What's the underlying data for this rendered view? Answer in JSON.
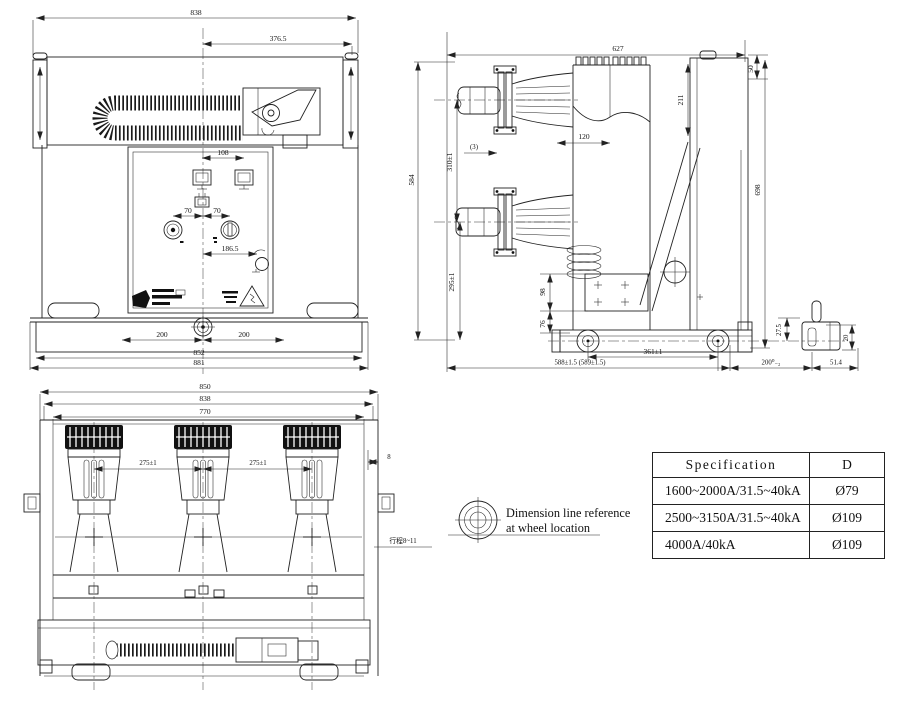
{
  "views": {
    "front": {
      "dims": {
        "total_width": "838",
        "offset_right": "376.5",
        "window_pitch": "108",
        "knob_left": "70",
        "knob_right": "70",
        "panel_dim": "186.5",
        "base_left": "200",
        "base_right": "200",
        "base_width": "852",
        "base_total": "881"
      }
    },
    "side": {
      "dims": {
        "top_depth": "627",
        "top_step": "50",
        "height": "584",
        "pole_pitch": "310±1",
        "note3": "(3)",
        "depth_120": "120",
        "frame_211": "211",
        "rear_height": "698",
        "arm_height": "295±1",
        "plate_98": "98",
        "plate_76": "76",
        "wheel_pitch": "361±1",
        "overall_depth": "588±1.5 (589±1.5)",
        "axle_27_5": "27.5",
        "ext_200": "200⁰₋₂",
        "ext_51_4": "51.4",
        "wheel_20": "20"
      }
    },
    "plan": {
      "dims": {
        "total_width": "850",
        "frame_width": "838",
        "inner_width": "770",
        "pole_pitch_1": "275±1",
        "pole_pitch_2": "275±1",
        "edge_8": "8",
        "travel": "行程8~11"
      }
    }
  },
  "note": {
    "line1": "Dimension line reference",
    "line2": "at wheel location"
  },
  "spec_table": {
    "header_spec": "Specification",
    "header_d": "D",
    "rows": [
      {
        "spec": "1600~2000A/31.5~40kA",
        "d": "Ø79"
      },
      {
        "spec": "2500~3150A/31.5~40kA",
        "d": "Ø109"
      },
      {
        "spec": "4000A/40kA",
        "d": "Ø109"
      }
    ]
  }
}
